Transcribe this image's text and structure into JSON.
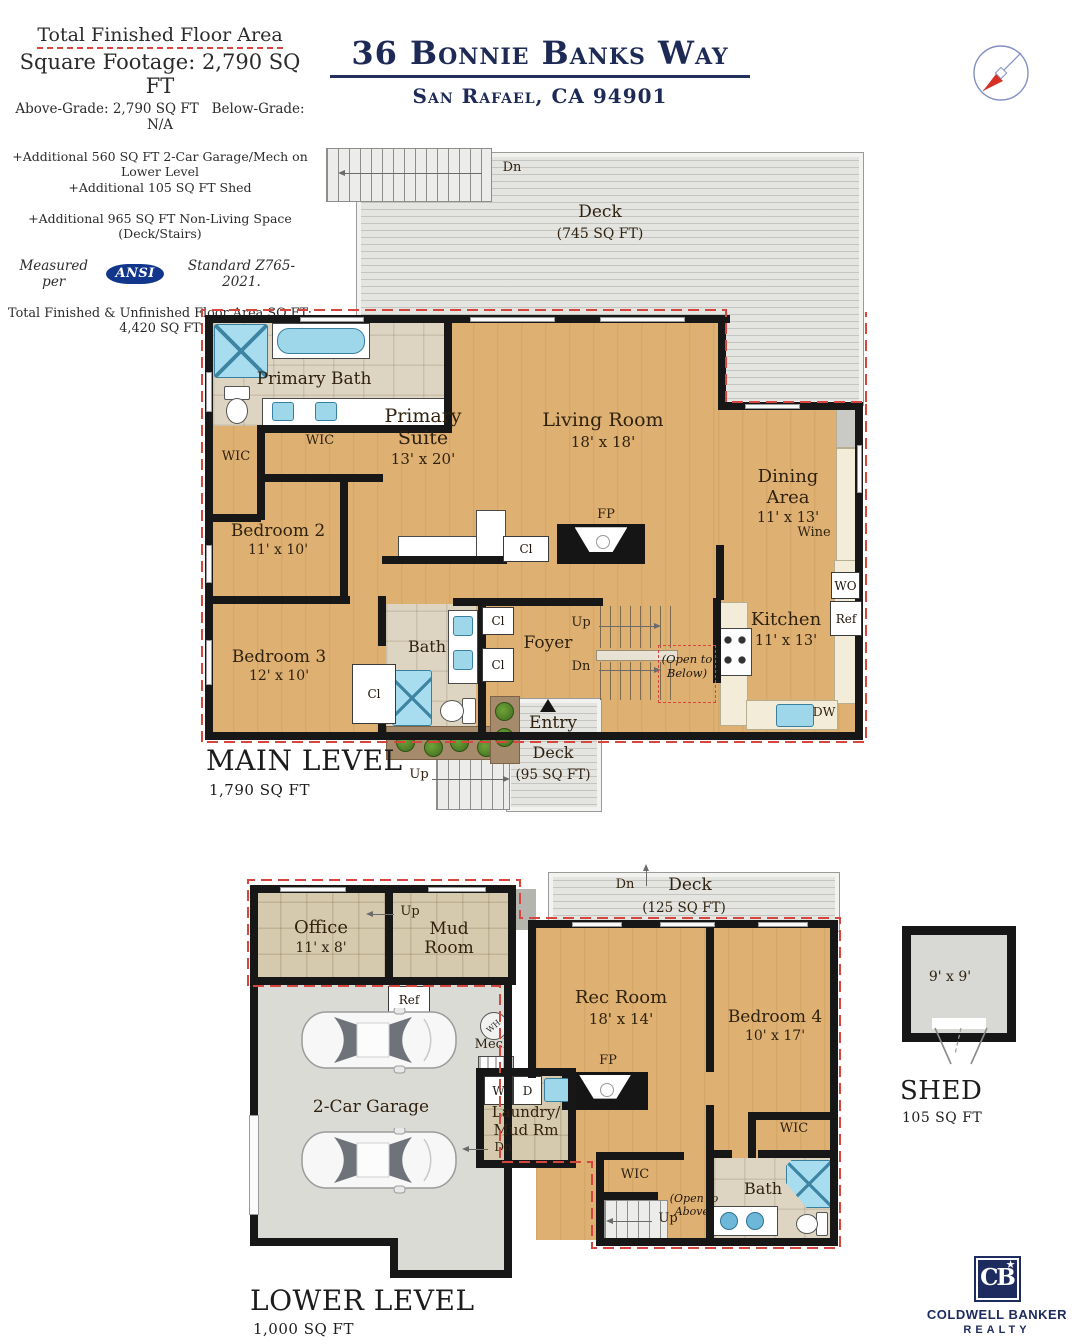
{
  "info_panel": {
    "heading": "Total Finished Floor Area",
    "sqft_line": "Square Footage: 2,790 SQ FT",
    "above_grade": "Above-Grade: 2,790 SQ FT",
    "below_grade": "Below-Grade: N/A",
    "additional_garage": "+Additional 560 SQ FT 2-Car Garage/Mech on Lower Level",
    "additional_shed": "+Additional 105 SQ FT Shed",
    "additional_nonliving": "+Additional 965 SQ FT  Non-Living Space (Deck/Stairs)",
    "measured_prefix": "Measured per",
    "ansi_logo": "ANSI",
    "measured_suffix": "Standard Z765-2021.",
    "total_line": "Total Finished & Unfinished Floor Area SQ FT: 4,420 SQ FT"
  },
  "header": {
    "address": "36 Bonnie Banks Way",
    "city_line": "San Rafael, CA 94901"
  },
  "labels": {
    "up": "Up",
    "dn": "Dn",
    "cl": "Cl",
    "wic": "WIC",
    "fp": "FP",
    "wo": "WO",
    "ref": "Ref",
    "dw": "DW",
    "wine": "Wine",
    "mech": "Mech",
    "wh": "WH",
    "w": "W",
    "d": "D",
    "open_below": "(Open to Below)",
    "open_above": "(Open to Above)"
  },
  "main_level": {
    "title": "MAIN LEVEL",
    "sqft": "1,790 SQ FT",
    "deck": {
      "name": "Deck",
      "sqft": "(745 SQ FT)"
    },
    "entry": {
      "name": "Entry",
      "deck": "Deck",
      "sqft": "(95 SQ FT)"
    },
    "rooms": {
      "primary_bath": "Primary Bath",
      "primary_suite": {
        "name": "Primary Suite",
        "dims": "13' x 20'"
      },
      "living_room": {
        "name": "Living Room",
        "dims": "18' x 18'"
      },
      "dining_area": {
        "name": "Dining Area",
        "dims": "11' x 13'"
      },
      "kitchen": {
        "name": "Kitchen",
        "dims": "11' x 13'"
      },
      "bedroom2": {
        "name": "Bedroom 2",
        "dims": "11' x 10'"
      },
      "bedroom3": {
        "name": "Bedroom 3",
        "dims": "12' x 10'"
      },
      "bath": "Bath",
      "foyer": "Foyer"
    }
  },
  "lower_level": {
    "title": "LOWER LEVEL",
    "sqft": "1,000 SQ FT",
    "deck": {
      "name": "Deck",
      "sqft": "(125 SQ FT)"
    },
    "rooms": {
      "office": {
        "name": "Office",
        "dims": "11' x 8'"
      },
      "mud_room": "Mud Room",
      "garage": "2-Car Garage",
      "rec_room": {
        "name": "Rec Room",
        "dims": "18' x 14'"
      },
      "bedroom4": {
        "name": "Bedroom 4",
        "dims": "10' x 17'"
      },
      "laundry_line1": "Laundry/",
      "laundry_line2": "Mud Rm",
      "bath": "Bath"
    }
  },
  "shed": {
    "dims": "9' x 9'",
    "title": "SHED",
    "sqft": "105 SQ FT"
  },
  "brand": {
    "monogram": "CB",
    "star": "★",
    "line1": "COLDWELL BANKER",
    "line2": "REALTY"
  }
}
